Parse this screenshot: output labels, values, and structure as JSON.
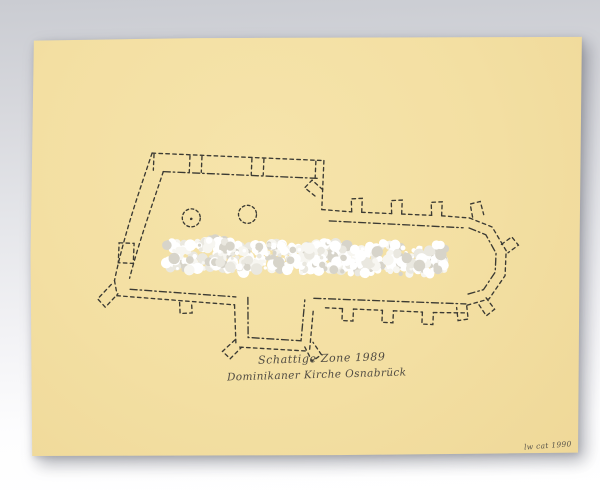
{
  "caption": {
    "line1": "Schattige Zone 1989",
    "line2": "Dominikaner Kirche Osnabrück"
  },
  "signature": "lw cat 1990",
  "colors": {
    "paper": "#f3dfa2",
    "ink": "#3b3a33",
    "relief_white": "#ffffff",
    "relief_shadow": "#d7d4ca",
    "background_top": "#caccd2",
    "background_bottom": "#ffffff"
  }
}
